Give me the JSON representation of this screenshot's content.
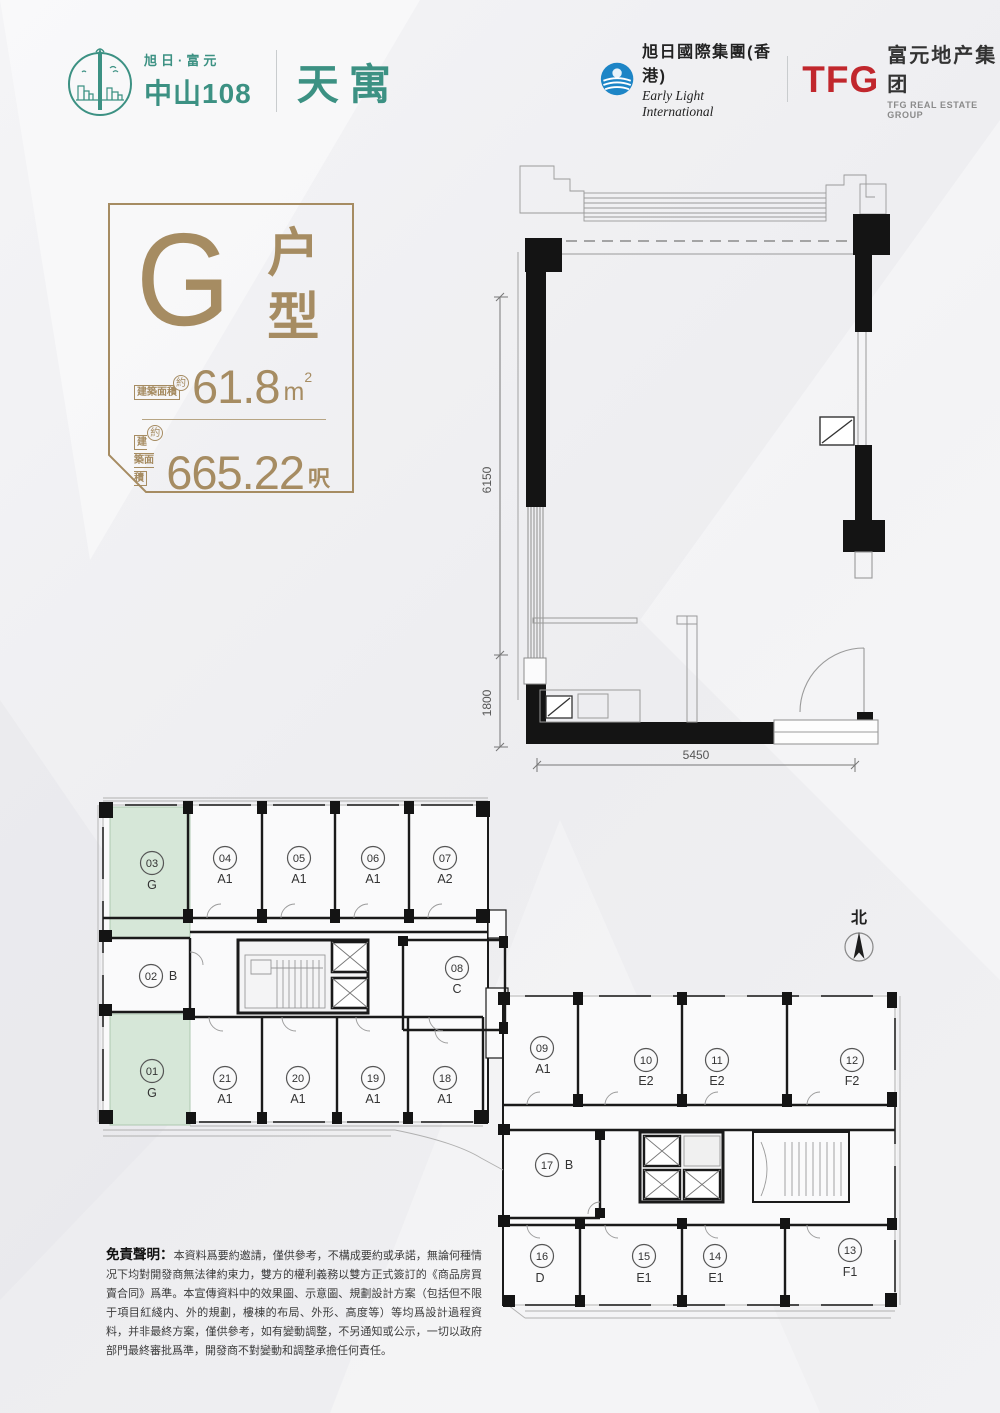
{
  "header": {
    "brand": {
      "pre_title": "旭日·富元",
      "title": "中山108",
      "product": "天寓"
    },
    "early_light": {
      "cn": "旭日國際集團(香港)",
      "en": "Early Light International"
    },
    "tfg": {
      "abbr": "TFG",
      "cn": "富元地产集团",
      "en": "TFG REAL ESTATE GROUP"
    }
  },
  "unit_card": {
    "letter": "G",
    "type_label": "户型",
    "rows": [
      {
        "badge": "建築面積",
        "approx": "約",
        "value": "61.8",
        "unit": "m",
        "unit_sup": "2"
      },
      {
        "badge": "建築面積",
        "approx": "約",
        "value": "665.22",
        "unit_cn": "呎"
      }
    ]
  },
  "unit_plan": {
    "dims": {
      "left_upper": "6150",
      "left_lower": "1800",
      "bottom": "5450"
    }
  },
  "floor_plate": {
    "north_label": "北",
    "units": [
      {
        "no": "01",
        "type": "G",
        "highlight": true
      },
      {
        "no": "02",
        "type": "B",
        "highlight": false
      },
      {
        "no": "03",
        "type": "G",
        "highlight": true
      },
      {
        "no": "04",
        "type": "A1",
        "highlight": false
      },
      {
        "no": "05",
        "type": "A1",
        "highlight": false
      },
      {
        "no": "06",
        "type": "A1",
        "highlight": false
      },
      {
        "no": "07",
        "type": "A2",
        "highlight": false
      },
      {
        "no": "08",
        "type": "C",
        "highlight": false
      },
      {
        "no": "09",
        "type": "A1",
        "highlight": false
      },
      {
        "no": "10",
        "type": "E2",
        "highlight": false
      },
      {
        "no": "11",
        "type": "E2",
        "highlight": false
      },
      {
        "no": "12",
        "type": "F2",
        "highlight": false
      },
      {
        "no": "13",
        "type": "F1",
        "highlight": false
      },
      {
        "no": "14",
        "type": "E1",
        "highlight": false
      },
      {
        "no": "15",
        "type": "E1",
        "highlight": false
      },
      {
        "no": "16",
        "type": "D",
        "highlight": false
      },
      {
        "no": "17",
        "type": "B",
        "highlight": false
      },
      {
        "no": "18",
        "type": "A1",
        "highlight": false
      },
      {
        "no": "19",
        "type": "A1",
        "highlight": false
      },
      {
        "no": "20",
        "type": "A1",
        "highlight": false
      },
      {
        "no": "21",
        "type": "A1",
        "highlight": false
      }
    ]
  },
  "disclaimer": {
    "heading": "免責聲明：",
    "body": "本資料爲要約邀請，僅供參考，不構成要約或承諾，無論何種情况下均對開發商無法律約束力，雙方的權利義務以雙方正式簽訂的《商品房買賣合同》爲準。本宣傳資料中的效果圖、示意圖、規劃設計方案（包括但不限于項目紅綫内、外的規劃，樓棟的布局、外形、高度等）等均爲設計過程資料，并非最終方案，僅供參考，如有變動調整，不另通知或公示，一切以政府部門最終審批爲準，開發商不對變動和調整承擔任何責任。"
  },
  "colors": {
    "gold": "#a68c62",
    "teal": "#3c9183",
    "red": "#c1272d",
    "blue": "#1d85c6",
    "green_fill": "#d6e7d8"
  }
}
